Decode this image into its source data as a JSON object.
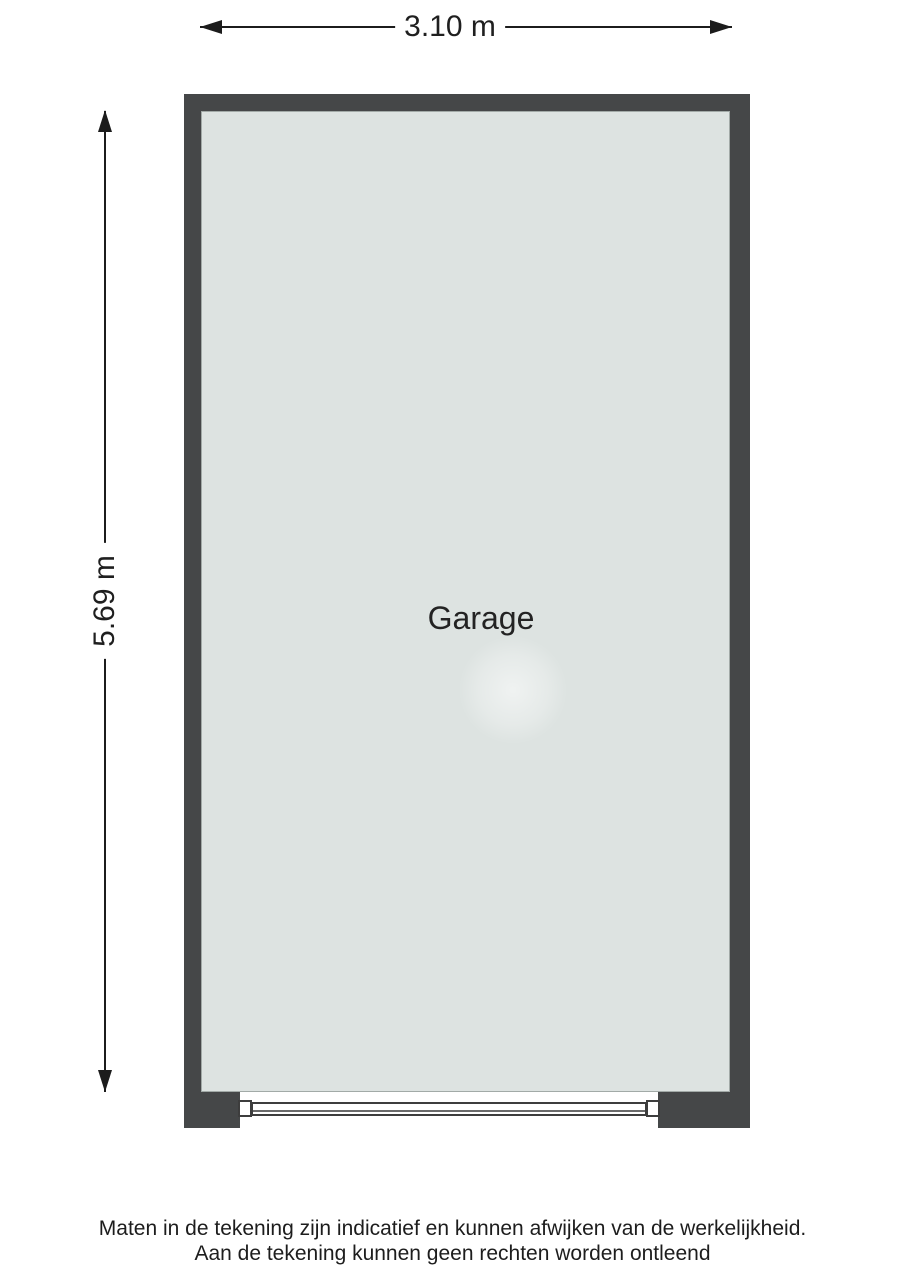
{
  "floorplan": {
    "room_label": "Garage",
    "dimensions": {
      "width_label": "3.10 m",
      "height_label": "5.69 m"
    },
    "colors": {
      "wall": "#454748",
      "floor": "#dde3e1",
      "line": "#1c1c1c",
      "text": "#1f1f1f"
    },
    "disclaimer": {
      "line1": "Maten in de tekening zijn indicatief en kunnen afwijken van de werkelijkheid.",
      "line2": "Aan de tekening kunnen geen rechten worden ontleend"
    }
  }
}
